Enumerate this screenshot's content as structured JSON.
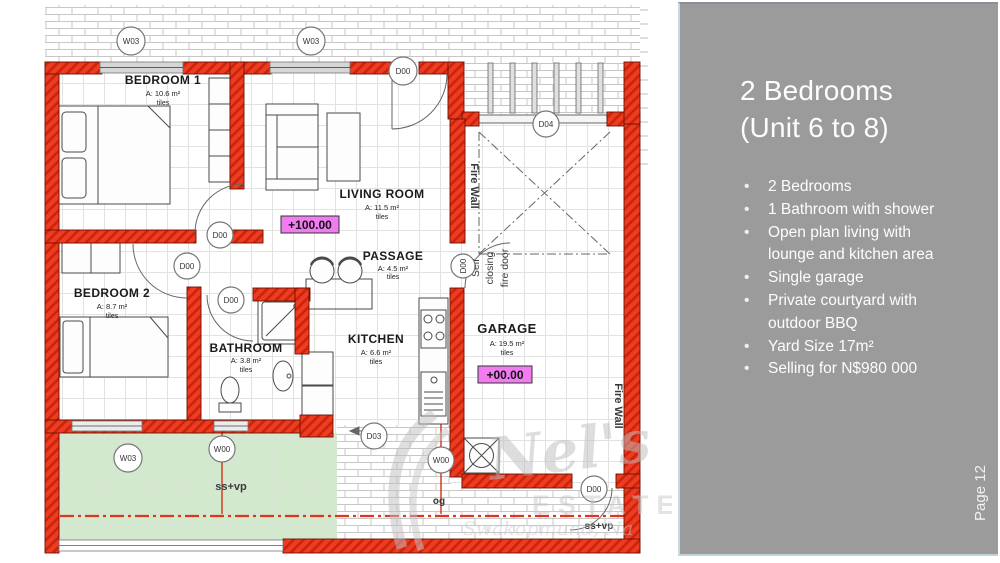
{
  "sidebar": {
    "title_line1": "2 Bedrooms",
    "title_line2": "(Unit 6 to 8)",
    "bullet_lines": [
      {
        "marker": "•",
        "text": "2 Bedrooms"
      },
      {
        "marker": "•",
        "text": "1 Bathroom with shower"
      },
      {
        "marker": "•",
        "text": "Open plan living with"
      },
      {
        "marker": "",
        "text": "lounge and kitchen area"
      },
      {
        "marker": "•",
        "text": "Single garage"
      },
      {
        "marker": "•",
        "text": "Private courtyard with"
      },
      {
        "marker": "",
        "text": "outdoor BBQ"
      },
      {
        "marker": "•",
        "text": "Yard Size 17m²"
      },
      {
        "marker": "•",
        "text": "Selling for N$980 000"
      }
    ],
    "page_label": "Page 12",
    "colors": {
      "background": "#9b9b9b",
      "text": "#ffffff"
    }
  },
  "plan": {
    "rooms": [
      {
        "name": "BEDROOM 1",
        "area": "A: 10.6 m²",
        "finish": "tiles"
      },
      {
        "name": "BEDROOM 2",
        "area": "A: 8.7 m²",
        "finish": "tiles"
      },
      {
        "name": "LIVING ROOM",
        "area": "A: 11.5 m²",
        "finish": "tiles"
      },
      {
        "name": "PASSAGE",
        "area": "A: 4.5 m²",
        "finish": "tiles"
      },
      {
        "name": "BATHROOM",
        "area": "A: 3.8 m²",
        "finish": "tiles"
      },
      {
        "name": "KITCHEN",
        "area": "A: 6.6 m²",
        "finish": "tiles"
      },
      {
        "name": "GARAGE",
        "area": "A: 19.5 m²",
        "finish": "tiles"
      }
    ],
    "levels": {
      "living_room": "+100.00",
      "garage": "+00.00"
    },
    "markers": {
      "w03": "W03",
      "w00": "W00",
      "d00": "D00",
      "d03": "D03",
      "d04": "D04"
    },
    "annotations": {
      "fire_wall": "Fire Wall",
      "self_closing_1": "Self",
      "self_closing_2": "closing",
      "self_closing_3": "fire door",
      "ssvp": "ss+vp",
      "og": "og"
    },
    "watermark": {
      "name": "Nel's",
      "estates": "ESTATES",
      "location": "Swakopmund, Na"
    },
    "colors": {
      "wall": "#ee3b22",
      "wall_hatch": "#c9250b",
      "level_bg": "#f07cf0",
      "courtyard": "#d2e9cd"
    }
  }
}
